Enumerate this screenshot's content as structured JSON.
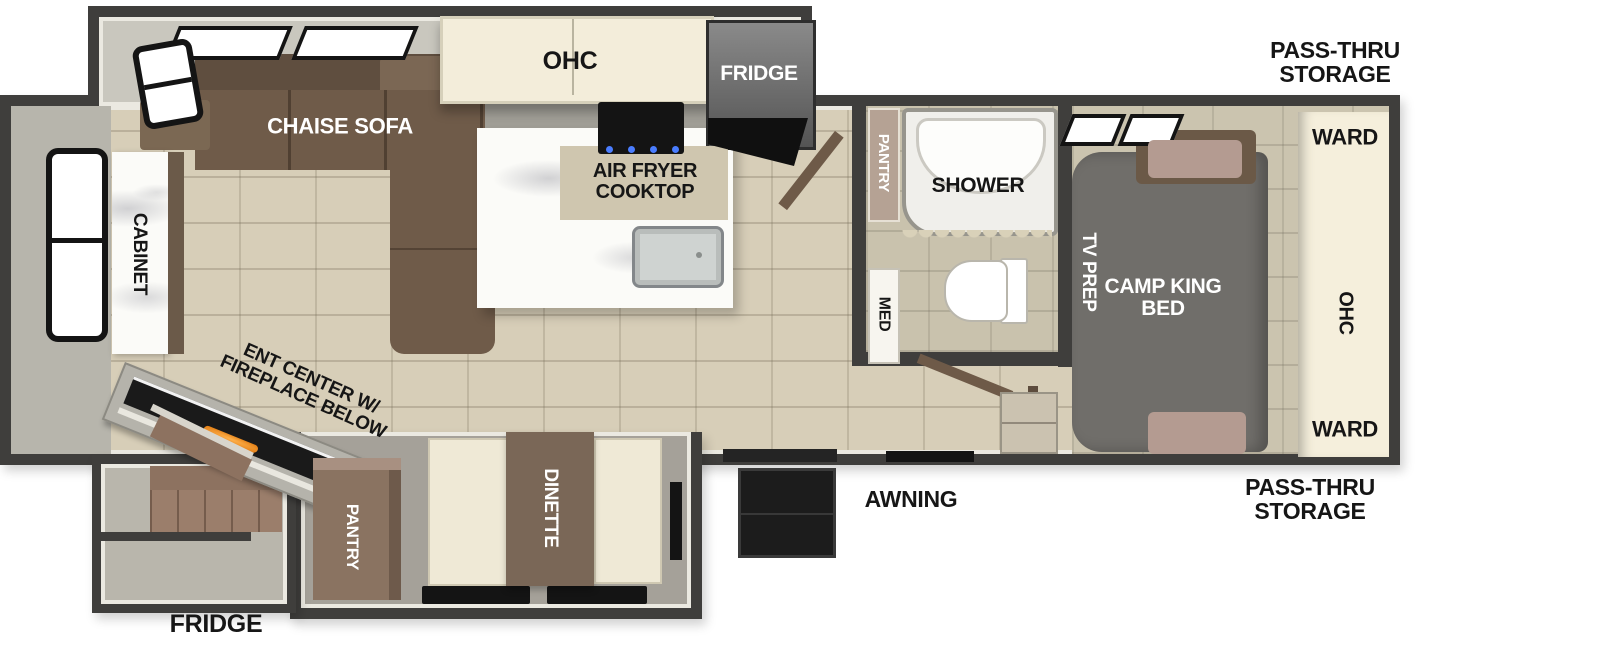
{
  "floorplan": {
    "labels": {
      "kitchen_ohc": "OHC",
      "kitchen_fridge": "FRIDGE",
      "chaise_sofa": "CHAISE SOFA",
      "air_fryer_cooktop": "AIR FRYER\nCOOKTOP",
      "pass_thru_storage_top": "PASS-THRU\nSTORAGE",
      "bath_pantry": "PANTRY",
      "shower": "SHOWER",
      "med": "MED",
      "tv_prep": "TV PREP",
      "camp_king_bed": "CAMP KING\nBED",
      "ward_top": "WARD",
      "bedroom_ohc": "OHC",
      "ward_bottom": "WARD",
      "cabinet": "CABINET",
      "ent_center": "ENT CENTER W/\nFIREPLACE BELOW",
      "kitchen_pantry": "PANTRY",
      "dinette": "DINETTE",
      "awning": "AWNING",
      "exterior_fridge": "FRIDGE",
      "pass_thru_storage_bottom": "PASS-THRU\nSTORAGE"
    },
    "colors": {
      "wall": "#3f3e3c",
      "floor_tile": "#d7ceb8",
      "slide_interior": "#c9c7be",
      "sofa_brown": "#6f5b49",
      "cabinet_cream": "#f3edda",
      "appliance_black": "#161616",
      "fridge_gray": "#6e6e6e",
      "counter_marble": "#fbfbf8",
      "island_tan": "#cfc6af",
      "bed_gray": "#706e6a",
      "pillow_blush": "#b49b91",
      "ward_cream": "#f5efdc",
      "bath_door_tan": "#b5a294",
      "dinette_brown": "#7a6757",
      "bench_cream": "#efe9d6",
      "stairs_brown": "#9b7e6b",
      "fireplace_orange": "#e08820",
      "label_black": "#161616",
      "label_white": "#ffffff"
    }
  }
}
